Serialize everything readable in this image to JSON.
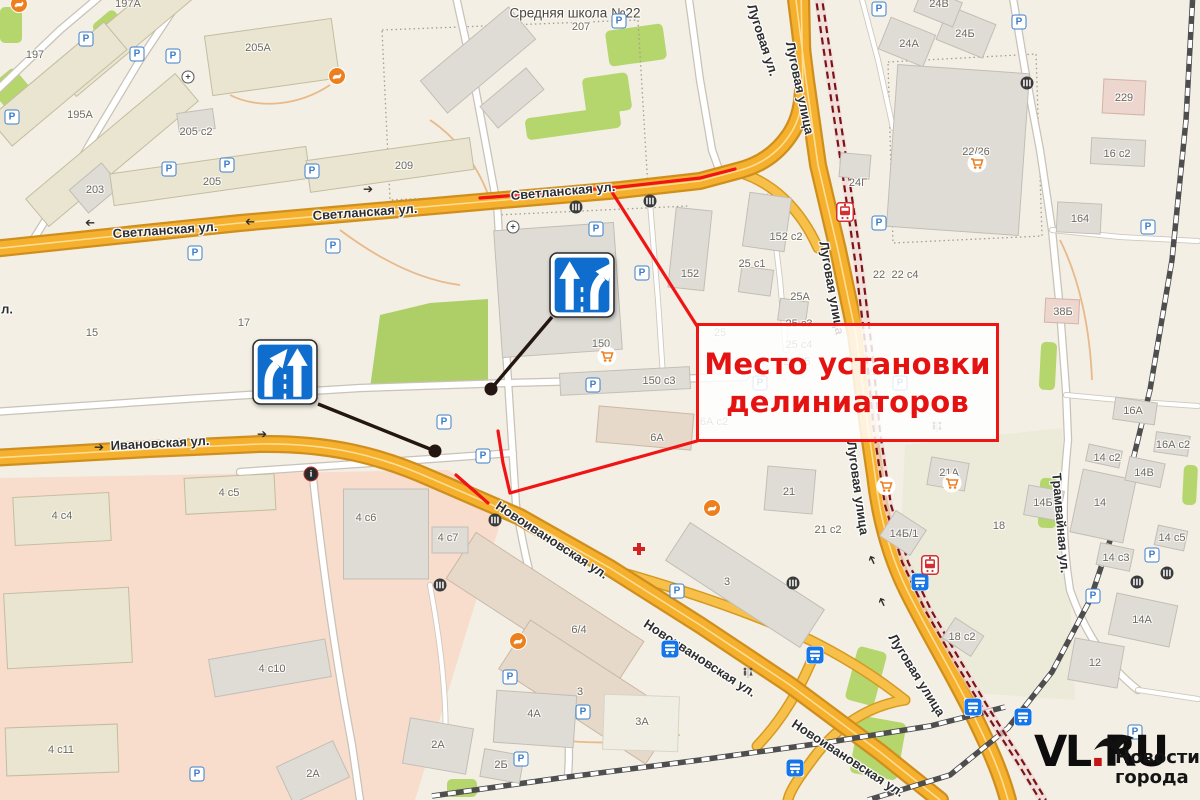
{
  "annotation": {
    "line1": "Место установки",
    "line2": "делиниаторов",
    "accent_color": "#ee1515"
  },
  "watermark": {
    "brand_pre": "VL",
    "brand_dot": ".",
    "brand_post": "RU",
    "tagline_line1": "Новости",
    "tagline_line2": "города",
    "dot_color": "#c41414"
  },
  "colors": {
    "road_orange": "#f5b02e",
    "tram_red": "#7c1416",
    "sign_blue": "#0f6ecd",
    "annotation_red": "#ee1515",
    "hospital_zone_pink": "#f8dccc",
    "green_area": "#b5d56d"
  },
  "street_labels": [
    {
      "t": "Светланская ул.",
      "x": 165,
      "y": 230,
      "r": -4
    },
    {
      "t": "Светланская ул.",
      "x": 365,
      "y": 212,
      "r": -4
    },
    {
      "t": "Светланская ул.",
      "x": 563,
      "y": 191,
      "r": -5
    },
    {
      "t": "Ивановская ул.",
      "x": 160,
      "y": 443,
      "r": -3
    },
    {
      "t": "Новоивановская ул.",
      "x": 552,
      "y": 540,
      "r": 33
    },
    {
      "t": "Новоивановская ул.",
      "x": 700,
      "y": 658,
      "r": 33
    },
    {
      "t": "Новоивановская ул.",
      "x": 848,
      "y": 758,
      "r": 33
    },
    {
      "t": "Луговая ул.",
      "x": 763,
      "y": 40,
      "r": 72
    },
    {
      "t": "Луговая улица",
      "x": 800,
      "y": 88,
      "r": 78
    },
    {
      "t": "Луговая улица",
      "x": 832,
      "y": 288,
      "r": 80
    },
    {
      "t": "Луговая улица",
      "x": 858,
      "y": 488,
      "r": 82
    },
    {
      "t": "Луговая улица",
      "x": 917,
      "y": 675,
      "r": 58
    },
    {
      "t": "Трамвайная ул.",
      "x": 1061,
      "y": 523,
      "r": 85
    },
    {
      "t": "л.",
      "x": 7,
      "y": 309,
      "r": 0
    }
  ],
  "building_labels": [
    {
      "t": "Средняя школа №22",
      "x": 575,
      "y": 13,
      "s": 13.5,
      "c": "#4a453c"
    },
    {
      "t": "207",
      "x": 581,
      "y": 27
    },
    {
      "t": "197А",
      "x": 128,
      "y": 4
    },
    {
      "t": "197",
      "x": 35,
      "y": 55
    },
    {
      "t": "195А",
      "x": 80,
      "y": 115
    },
    {
      "t": "203",
      "x": 95,
      "y": 190
    },
    {
      "t": "205",
      "x": 212,
      "y": 182
    },
    {
      "t": "205 с2",
      "x": 196,
      "y": 132
    },
    {
      "t": "205А",
      "x": 258,
      "y": 48
    },
    {
      "t": "209",
      "x": 404,
      "y": 166
    },
    {
      "t": "15",
      "x": 92,
      "y": 333
    },
    {
      "t": "17",
      "x": 244,
      "y": 323
    },
    {
      "t": "150",
      "x": 601,
      "y": 344
    },
    {
      "t": "150 с3",
      "x": 659,
      "y": 381
    },
    {
      "t": "152 с2",
      "x": 786,
      "y": 237
    },
    {
      "t": "152",
      "x": 690,
      "y": 274
    },
    {
      "t": "25 с1",
      "x": 752,
      "y": 264
    },
    {
      "t": "25А",
      "x": 800,
      "y": 297
    },
    {
      "t": "25 с3",
      "x": 799,
      "y": 324
    },
    {
      "t": "25",
      "x": 720,
      "y": 333
    },
    {
      "t": "25 с4",
      "x": 799,
      "y": 345
    },
    {
      "t": "25 с5",
      "x": 797,
      "y": 362
    },
    {
      "t": "6А с2",
      "x": 714,
      "y": 422
    },
    {
      "t": "6А",
      "x": 657,
      "y": 438
    },
    {
      "t": "22",
      "x": 879,
      "y": 275
    },
    {
      "t": "22 с4",
      "x": 905,
      "y": 275
    },
    {
      "t": "24Г",
      "x": 858,
      "y": 183
    },
    {
      "t": "24А",
      "x": 909,
      "y": 44
    },
    {
      "t": "24Б",
      "x": 965,
      "y": 34
    },
    {
      "t": "24В",
      "x": 939,
      "y": 4
    },
    {
      "t": "22/26",
      "x": 976,
      "y": 152
    },
    {
      "t": "229",
      "x": 1124,
      "y": 98
    },
    {
      "t": "16 с2",
      "x": 1117,
      "y": 154
    },
    {
      "t": "164",
      "x": 1080,
      "y": 219
    },
    {
      "t": "38Б",
      "x": 1063,
      "y": 312
    },
    {
      "t": "16А",
      "x": 1133,
      "y": 411
    },
    {
      "t": "16А с2",
      "x": 1173,
      "y": 445
    },
    {
      "t": "14 с2",
      "x": 1107,
      "y": 458
    },
    {
      "t": "14В",
      "x": 1144,
      "y": 473
    },
    {
      "t": "14Б",
      "x": 1043,
      "y": 503
    },
    {
      "t": "14",
      "x": 1100,
      "y": 503
    },
    {
      "t": "14 с3",
      "x": 1116,
      "y": 558
    },
    {
      "t": "14 с5",
      "x": 1172,
      "y": 538
    },
    {
      "t": "14А",
      "x": 1142,
      "y": 620
    },
    {
      "t": "12",
      "x": 1095,
      "y": 663
    },
    {
      "t": "21А",
      "x": 949,
      "y": 473
    },
    {
      "t": "21 с2",
      "x": 828,
      "y": 530
    },
    {
      "t": "14Б/1",
      "x": 904,
      "y": 534
    },
    {
      "t": "18",
      "x": 999,
      "y": 526
    },
    {
      "t": "18 с2",
      "x": 962,
      "y": 637
    },
    {
      "t": "21",
      "x": 789,
      "y": 492
    },
    {
      "t": "3",
      "x": 727,
      "y": 582
    },
    {
      "t": "3",
      "x": 580,
      "y": 692
    },
    {
      "t": "6/4",
      "x": 579,
      "y": 630
    },
    {
      "t": "4А",
      "x": 534,
      "y": 714
    },
    {
      "t": "3А",
      "x": 642,
      "y": 722
    },
    {
      "t": "2А",
      "x": 438,
      "y": 745
    },
    {
      "t": "2Б",
      "x": 501,
      "y": 765
    },
    {
      "t": "2А",
      "x": 313,
      "y": 774
    },
    {
      "t": "4 с4",
      "x": 62,
      "y": 516
    },
    {
      "t": "4 с5",
      "x": 229,
      "y": 493
    },
    {
      "t": "4 с6",
      "x": 366,
      "y": 518
    },
    {
      "t": "4 с7",
      "x": 448,
      "y": 538
    },
    {
      "t": "4 с10",
      "x": 272,
      "y": 669
    },
    {
      "t": "4 с11",
      "x": 61,
      "y": 750
    }
  ],
  "icons": [
    {
      "type": "parking",
      "x": 86,
      "y": 39
    },
    {
      "type": "parking",
      "x": 137,
      "y": 54
    },
    {
      "type": "parking",
      "x": 173,
      "y": 56
    },
    {
      "type": "parking",
      "x": 12,
      "y": 117
    },
    {
      "type": "parking",
      "x": 169,
      "y": 169
    },
    {
      "type": "parking",
      "x": 227,
      "y": 165
    },
    {
      "type": "parking",
      "x": 312,
      "y": 171
    },
    {
      "type": "parking",
      "x": 195,
      "y": 253
    },
    {
      "type": "parking",
      "x": 333,
      "y": 246
    },
    {
      "type": "parking",
      "x": 619,
      "y": 21
    },
    {
      "type": "parking",
      "x": 596,
      "y": 229
    },
    {
      "type": "parking",
      "x": 642,
      "y": 273
    },
    {
      "type": "parking",
      "x": 879,
      "y": 9
    },
    {
      "type": "parking",
      "x": 1019,
      "y": 22
    },
    {
      "type": "parking",
      "x": 1148,
      "y": 227
    },
    {
      "type": "parking",
      "x": 879,
      "y": 223
    },
    {
      "type": "parking",
      "x": 593,
      "y": 385
    },
    {
      "type": "parking",
      "x": 444,
      "y": 422
    },
    {
      "type": "parking",
      "x": 483,
      "y": 456
    },
    {
      "type": "parking",
      "x": 677,
      "y": 591
    },
    {
      "type": "parking",
      "x": 510,
      "y": 677
    },
    {
      "type": "parking",
      "x": 583,
      "y": 712
    },
    {
      "type": "parking",
      "x": 521,
      "y": 759
    },
    {
      "type": "parking",
      "x": 197,
      "y": 774
    },
    {
      "type": "parking",
      "x": 1152,
      "y": 555
    },
    {
      "type": "parking",
      "x": 1093,
      "y": 596
    },
    {
      "type": "parking",
      "x": 1135,
      "y": 732
    },
    {
      "type": "parking",
      "x": 760,
      "y": 383
    },
    {
      "type": "parking",
      "x": 900,
      "y": 383
    },
    {
      "type": "bus",
      "x": 670,
      "y": 649
    },
    {
      "type": "bus",
      "x": 815,
      "y": 655
    },
    {
      "type": "bus",
      "x": 920,
      "y": 582
    },
    {
      "type": "bus",
      "x": 973,
      "y": 707
    },
    {
      "type": "bus",
      "x": 1023,
      "y": 717
    },
    {
      "type": "bus",
      "x": 795,
      "y": 768
    },
    {
      "type": "tram",
      "x": 845,
      "y": 212
    },
    {
      "type": "tram",
      "x": 930,
      "y": 565
    },
    {
      "type": "cart",
      "x": 607,
      "y": 356
    },
    {
      "type": "cart",
      "x": 977,
      "y": 163
    },
    {
      "type": "cart",
      "x": 886,
      "y": 486
    },
    {
      "type": "cart",
      "x": 952,
      "y": 483
    },
    {
      "type": "dog",
      "x": 19,
      "y": 4
    },
    {
      "type": "dog",
      "x": 337,
      "y": 76
    },
    {
      "type": "dog",
      "x": 712,
      "y": 508
    },
    {
      "type": "dog",
      "x": 518,
      "y": 641
    },
    {
      "type": "med",
      "x": 639,
      "y": 549
    },
    {
      "type": "info",
      "x": 311,
      "y": 474
    },
    {
      "type": "cross",
      "x": 576,
      "y": 207
    },
    {
      "type": "cross",
      "x": 650,
      "y": 201
    },
    {
      "type": "cross",
      "x": 495,
      "y": 520
    },
    {
      "type": "cross",
      "x": 440,
      "y": 585
    },
    {
      "type": "cross",
      "x": 793,
      "y": 583
    },
    {
      "type": "cross",
      "x": 1137,
      "y": 582
    },
    {
      "type": "cross",
      "x": 1027,
      "y": 83
    },
    {
      "type": "cross",
      "x": 1167,
      "y": 573
    },
    {
      "type": "wc",
      "x": 748,
      "y": 673
    },
    {
      "type": "wc",
      "x": 937,
      "y": 427
    },
    {
      "type": "sig",
      "x": 188,
      "y": 77
    },
    {
      "type": "sig",
      "x": 513,
      "y": 227
    },
    {
      "type": "arrow",
      "x": 90,
      "y": 223,
      "r": 180
    },
    {
      "type": "arrow",
      "x": 250,
      "y": 222,
      "r": 180
    },
    {
      "type": "arrow",
      "x": 368,
      "y": 189,
      "r": 0
    },
    {
      "type": "arrow",
      "x": 99,
      "y": 447,
      "r": 0
    },
    {
      "type": "arrow",
      "x": 262,
      "y": 434,
      "r": 0
    },
    {
      "type": "arrow",
      "x": 872,
      "y": 560,
      "r": -115
    },
    {
      "type": "arrow",
      "x": 882,
      "y": 602,
      "r": -115
    }
  ]
}
